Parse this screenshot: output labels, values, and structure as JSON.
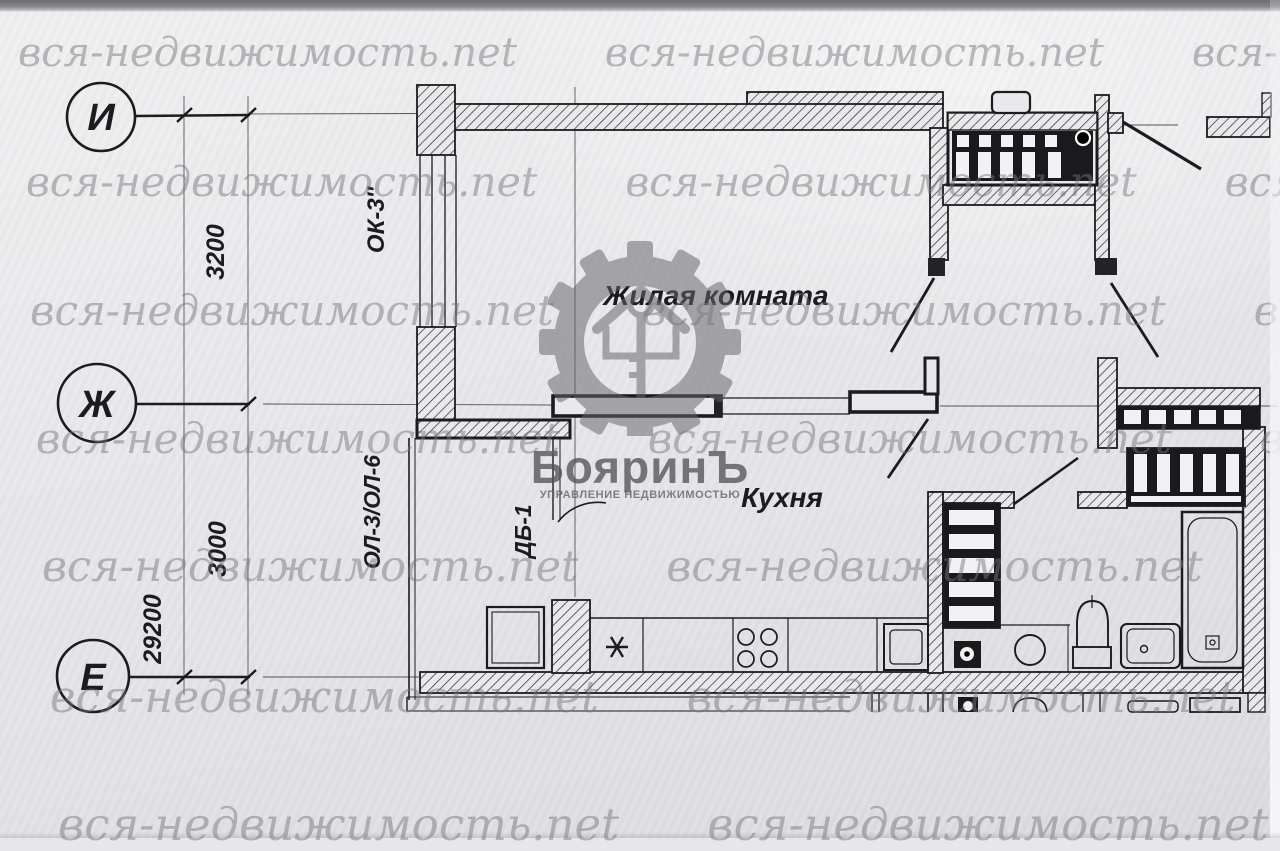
{
  "watermark": {
    "text": "вся-недвижимость.net"
  },
  "logo": {
    "title": "БояринЪ",
    "subtitle": "УПРАВЛЕНИЕ НЕДВИЖИМОСТЬЮ",
    "icon": "gear-house-key"
  },
  "plan": {
    "rooms": [
      {
        "label": "Жилая комната"
      },
      {
        "label": "Кухня"
      }
    ],
    "axes": [
      {
        "label": "И"
      },
      {
        "label": "Ж"
      },
      {
        "label": "Е"
      }
    ],
    "dimensions": [
      {
        "value": "3200"
      },
      {
        "value": "3000"
      },
      {
        "value": "29200"
      }
    ],
    "marks": [
      {
        "label": "ОК-3''"
      },
      {
        "label": "ОЛ-3/ОЛ-6"
      },
      {
        "label": "ДБ-1"
      }
    ]
  },
  "colors": {
    "paper": "#e8e8ea",
    "ink": "#1c1c1f",
    "watermark": "#76767c",
    "logo_gray": "#6e6e73"
  }
}
